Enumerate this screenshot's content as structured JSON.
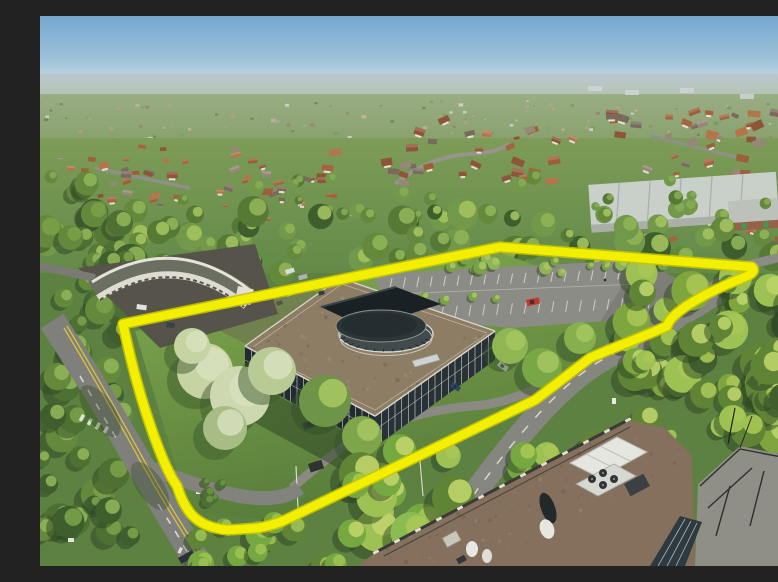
{
  "meta": {
    "scene_type": "aerial-property-photograph",
    "description": "Aerial drone photo of a two-storey glass courtyard office building with a central oval tower bearing a red sign, its car park and lawned grounds outlined by a thick yellow site-boundary line, surrounded by suburban housing, an industrial warehouse, roads and dense spring trees; a large rooftop with plant equipment fills the foreground corner"
  },
  "palette": {
    "sky_top": "#74a7d0",
    "sky_mid": "#9fc2d9",
    "sky_horizon": "#d3dfe5",
    "haze_top": "#b9c8d0",
    "haze_bottom": "#b4c1a8",
    "distant_top": "#9aad85",
    "distant_bottom": "#87a06a",
    "suburb_top": "#7d9c58",
    "suburb_bottom": "#638a48",
    "ground_green": "#5d8140",
    "lawn_light": "#82ab4e",
    "lawn_dark": "#567a3a",
    "tree_dark": "#3f5e2d",
    "tree_mid": "#64883c",
    "tree_bright": "#9dc153",
    "tree_pale": "#c6d3a2",
    "asphalt": "#8c8c86",
    "asphalt_dark": "#6b6d64",
    "road_marking": "#eceae2",
    "double_yellow": "#d8c23c",
    "office_roof": "#8d7d64",
    "glass_dark": "#222c30",
    "glass_dark2": "#283236",
    "mullion": "#d6dbda",
    "courtyard_dark": "#1a2124",
    "tower_top": "#2c3538",
    "tower_wall": "#414b4e",
    "tower_rim": "#d9d9d2",
    "sign_red": "#c23a2e",
    "warehouse_roof": "#c9cfc9",
    "warehouse_front": "#aab0a8",
    "brick_unit": "#96604a",
    "curved_building_wall": "#dedcd2",
    "curved_building_roof": "#6a6f62",
    "tarmac_shade": "#55534a",
    "foreground_roof": "#85705d",
    "parapet_cap": "#e4e0d6",
    "plant_white": "#e6e6e1",
    "concrete_deck": "#8f8f88",
    "car_red": "#c0392b",
    "car_white": "#e9ecec",
    "car_blue": "#2e4a6e",
    "car_dark": "#30363c",
    "boundary_fill": "#f2f000",
    "boundary_edge": "#c9c400"
  },
  "boundary": {
    "path": "M 83,308 L 460,231 L 712,251 Q 717,256 705,261 C 682,270 652,284 636,298 Q 629,304 627,310 C 608,319 572,332 550,342 C 525,361 510,373 495,384 L 243,505 Q 230,510 218,512 L 188,514 Q 164,512 152,499 Q 143,489 137,470 C 124,452 100,390 83,308 Z",
    "stroke_width": 8.5,
    "edge_width": 11.5
  }
}
